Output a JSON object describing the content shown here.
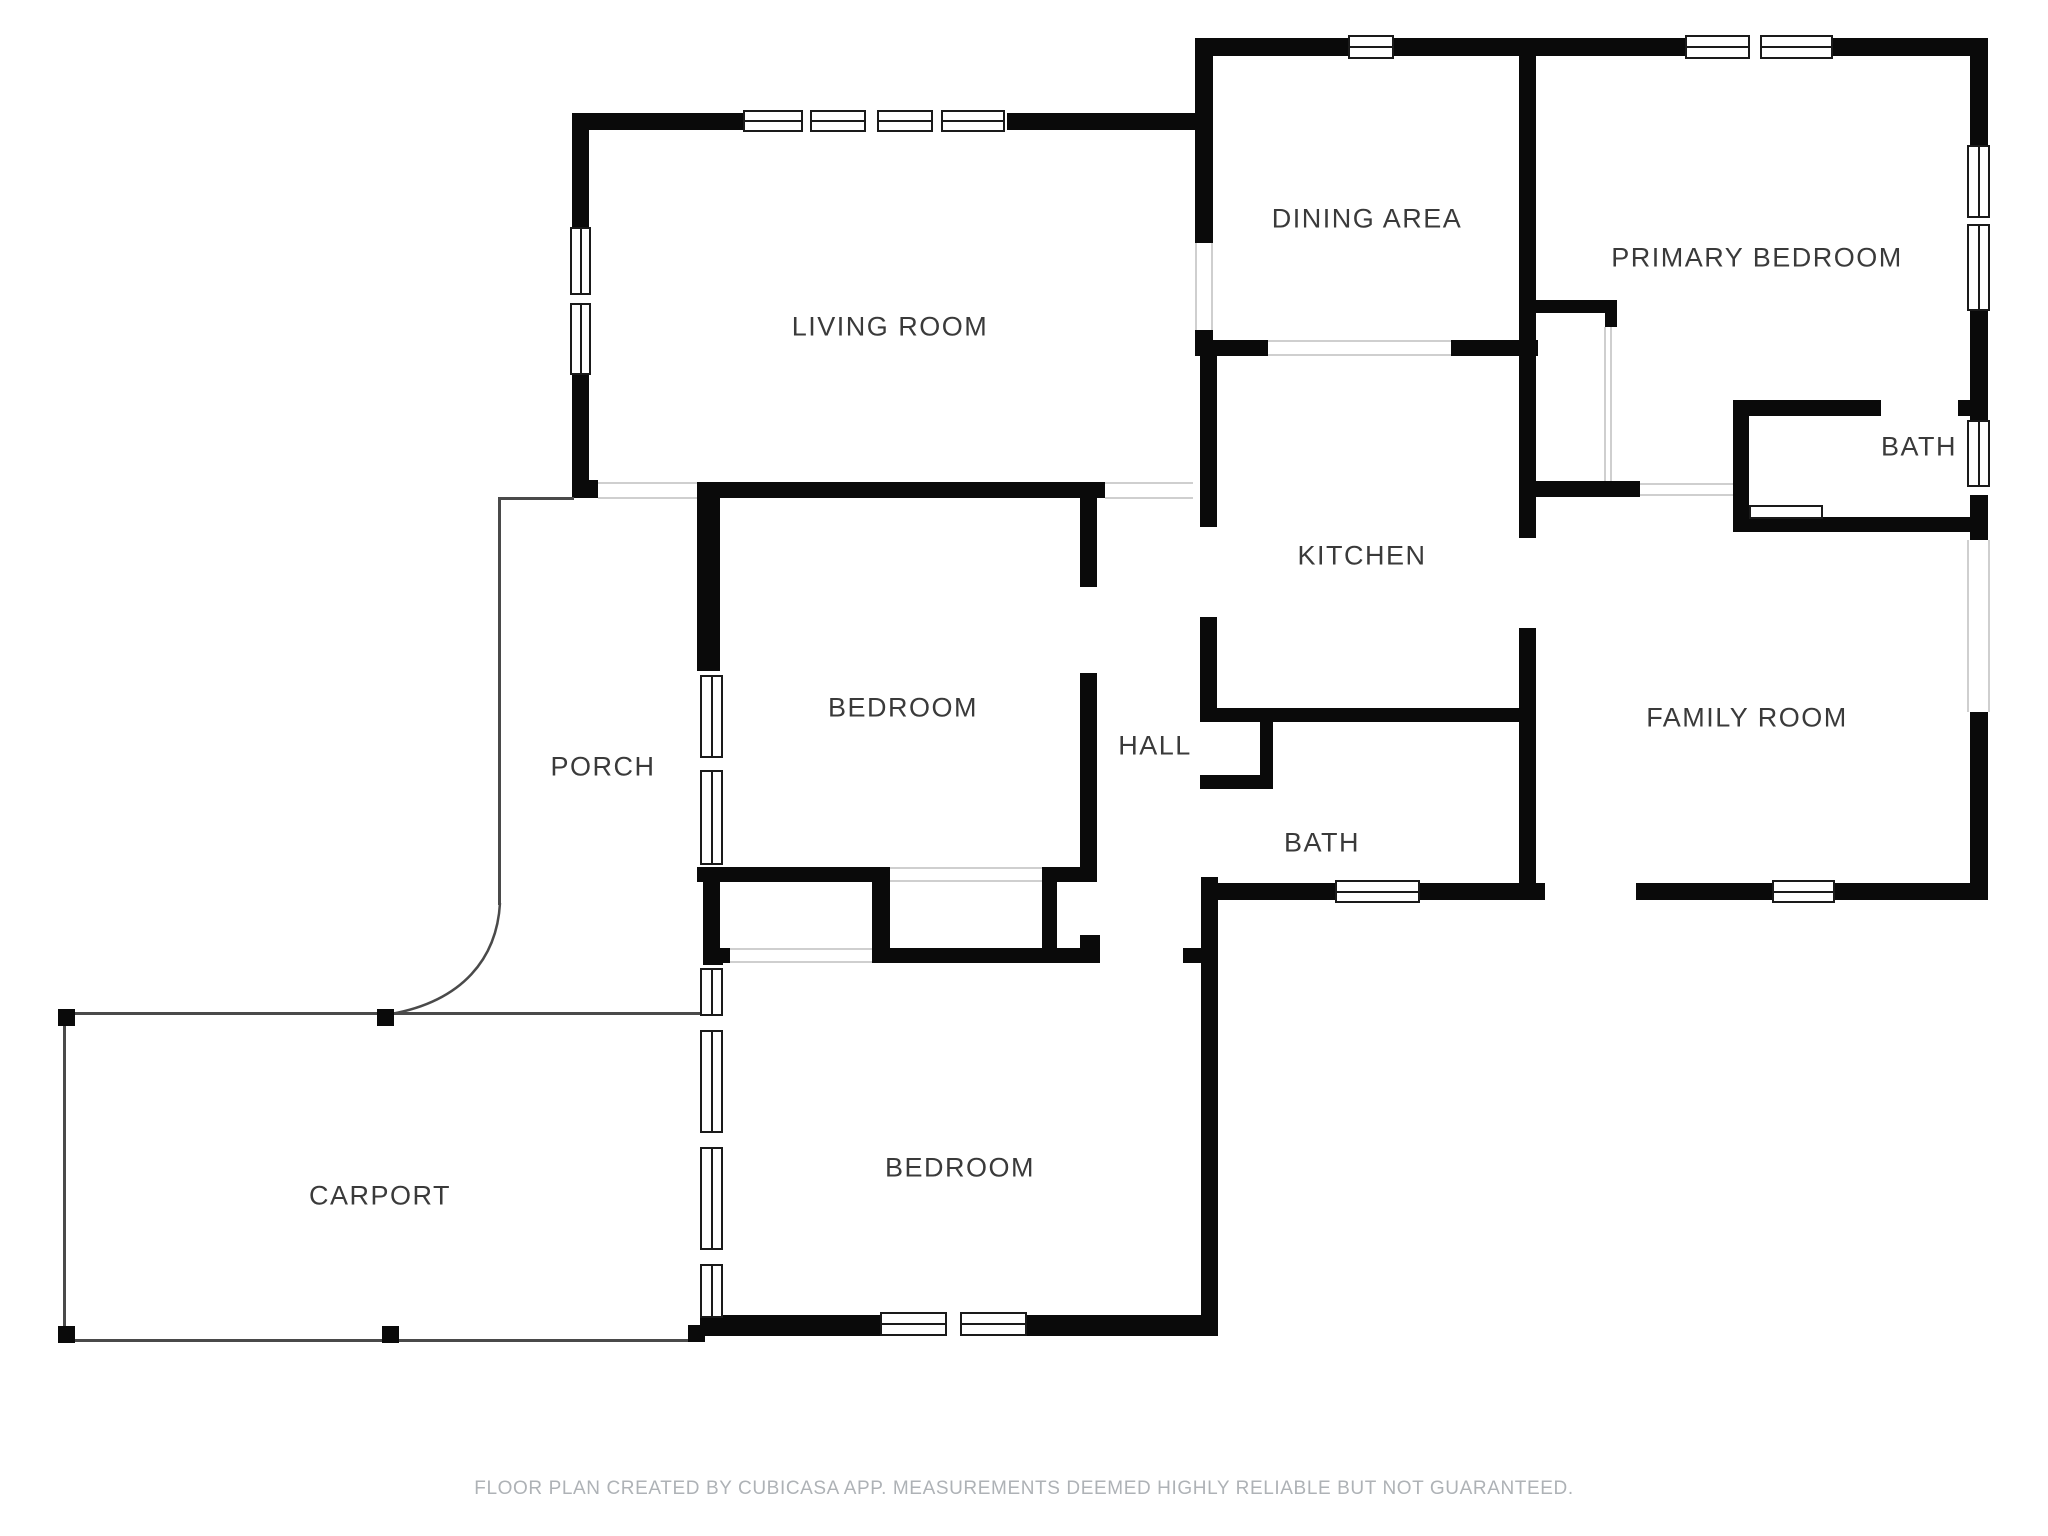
{
  "page": {
    "width": 2048,
    "height": 1536,
    "background": "#ffffff"
  },
  "footer": {
    "text": "FLOOR PLAN CREATED BY CUBICASA APP. MEASUREMENTS DEEMED HIGHLY RELIABLE BUT NOT GUARANTEED."
  },
  "colors": {
    "wall": "#0a0a0a",
    "label": "#3a3a3a",
    "outline": "#4a4a4a",
    "opening_edge": "#cfcfcf",
    "window_frame": "#1a1a1a",
    "footer_text": "#aeb2b6"
  },
  "rooms": [
    {
      "id": "living-room",
      "label": "LIVING ROOM",
      "cx": 890,
      "cy": 327
    },
    {
      "id": "dining-area",
      "label": "DINING AREA",
      "cx": 1367,
      "cy": 219
    },
    {
      "id": "primary-bedroom",
      "label": "PRIMARY BEDROOM",
      "cx": 1757,
      "cy": 258
    },
    {
      "id": "bath-upper",
      "label": "BATH",
      "cx": 1919,
      "cy": 447
    },
    {
      "id": "kitchen",
      "label": "KITCHEN",
      "cx": 1362,
      "cy": 556
    },
    {
      "id": "hall",
      "label": "HALL",
      "cx": 1155,
      "cy": 746
    },
    {
      "id": "family-room",
      "label": "FAMILY ROOM",
      "cx": 1747,
      "cy": 718
    },
    {
      "id": "bath-center",
      "label": "BATH",
      "cx": 1322,
      "cy": 843
    },
    {
      "id": "bedroom-middle",
      "label": "BEDROOM",
      "cx": 903,
      "cy": 708
    },
    {
      "id": "bedroom-bottom",
      "label": "BEDROOM",
      "cx": 960,
      "cy": 1168
    },
    {
      "id": "porch",
      "label": "PORCH",
      "cx": 603,
      "cy": 767
    },
    {
      "id": "carport",
      "label": "CARPORT",
      "cx": 380,
      "cy": 1196
    }
  ],
  "walls": [
    {
      "x": 572,
      "y": 113,
      "w": 641,
      "h": 17
    },
    {
      "x": 1195,
      "y": 38,
      "w": 343,
      "h": 18
    },
    {
      "x": 1521,
      "y": 38,
      "w": 467,
      "h": 18
    },
    {
      "x": 572,
      "y": 113,
      "w": 17,
      "h": 114
    },
    {
      "x": 572,
      "y": 375,
      "w": 17,
      "h": 105
    },
    {
      "x": 572,
      "y": 480,
      "w": 26,
      "h": 18
    },
    {
      "x": 697,
      "y": 482,
      "w": 408,
      "h": 16
    },
    {
      "x": 1195,
      "y": 38,
      "w": 18,
      "h": 205
    },
    {
      "x": 1195,
      "y": 330,
      "w": 18,
      "h": 26
    },
    {
      "x": 1195,
      "y": 340,
      "w": 73,
      "h": 16
    },
    {
      "x": 1451,
      "y": 340,
      "w": 87,
      "h": 16
    },
    {
      "x": 1519,
      "y": 38,
      "w": 17,
      "h": 500
    },
    {
      "x": 1519,
      "y": 628,
      "w": 17,
      "h": 272
    },
    {
      "x": 1970,
      "y": 38,
      "w": 18,
      "h": 107
    },
    {
      "x": 1970,
      "y": 311,
      "w": 18,
      "h": 109
    },
    {
      "x": 1970,
      "y": 492,
      "w": 18,
      "h": 48
    },
    {
      "x": 1970,
      "y": 712,
      "w": 18,
      "h": 188
    },
    {
      "x": 1536,
      "y": 300,
      "w": 81,
      "h": 13
    },
    {
      "x": 1605,
      "y": 313,
      "w": 12,
      "h": 14
    },
    {
      "x": 1519,
      "y": 481,
      "w": 121,
      "h": 16
    },
    {
      "x": 1733,
      "y": 400,
      "w": 148,
      "h": 16
    },
    {
      "x": 1958,
      "y": 400,
      "w": 12,
      "h": 16
    },
    {
      "x": 1733,
      "y": 400,
      "w": 16,
      "h": 130
    },
    {
      "x": 1733,
      "y": 517,
      "w": 237,
      "h": 15
    },
    {
      "x": 1200,
      "y": 342,
      "w": 17,
      "h": 185
    },
    {
      "x": 1200,
      "y": 617,
      "w": 17,
      "h": 105
    },
    {
      "x": 1200,
      "y": 708,
      "w": 336,
      "h": 14
    },
    {
      "x": 1260,
      "y": 722,
      "w": 13,
      "h": 67
    },
    {
      "x": 1200,
      "y": 775,
      "w": 73,
      "h": 14
    },
    {
      "x": 697,
      "y": 482,
      "w": 23,
      "h": 189
    },
    {
      "x": 1080,
      "y": 493,
      "w": 17,
      "h": 94
    },
    {
      "x": 1080,
      "y": 673,
      "w": 17,
      "h": 194
    },
    {
      "x": 697,
      "y": 867,
      "w": 193,
      "h": 15
    },
    {
      "x": 1042,
      "y": 867,
      "w": 55,
      "h": 15
    },
    {
      "x": 703,
      "y": 882,
      "w": 17,
      "h": 66
    },
    {
      "x": 872,
      "y": 882,
      "w": 18,
      "h": 66
    },
    {
      "x": 1042,
      "y": 882,
      "w": 15,
      "h": 66
    },
    {
      "x": 1080,
      "y": 935,
      "w": 20,
      "h": 17
    },
    {
      "x": 703,
      "y": 948,
      "w": 27,
      "h": 15
    },
    {
      "x": 872,
      "y": 948,
      "w": 228,
      "h": 15
    },
    {
      "x": 1183,
      "y": 948,
      "w": 35,
      "h": 15
    },
    {
      "x": 1201,
      "y": 877,
      "w": 17,
      "h": 459
    },
    {
      "x": 1202,
      "y": 883,
      "w": 133,
      "h": 17
    },
    {
      "x": 1420,
      "y": 883,
      "w": 116,
      "h": 17
    },
    {
      "x": 1519,
      "y": 883,
      "w": 26,
      "h": 17
    },
    {
      "x": 1636,
      "y": 883,
      "w": 136,
      "h": 17
    },
    {
      "x": 1835,
      "y": 883,
      "w": 153,
      "h": 17
    },
    {
      "x": 703,
      "y": 948,
      "w": 20,
      "h": 22
    },
    {
      "x": 700,
      "y": 1318,
      "w": 23,
      "h": 18
    },
    {
      "x": 703,
      "y": 1315,
      "w": 177,
      "h": 21
    },
    {
      "x": 1027,
      "y": 1315,
      "w": 191,
      "h": 21
    }
  ],
  "openings": [
    {
      "x": 598,
      "y": 482,
      "w": 99,
      "h": 17,
      "orient": "h",
      "lines": true
    },
    {
      "x": 1105,
      "y": 482,
      "w": 88,
      "h": 17,
      "orient": "h",
      "lines": true
    },
    {
      "x": 1195,
      "y": 243,
      "w": 18,
      "h": 87,
      "orient": "v",
      "lines": true
    },
    {
      "x": 1268,
      "y": 340,
      "w": 183,
      "h": 16,
      "orient": "h",
      "lines": true
    },
    {
      "x": 890,
      "y": 867,
      "w": 152,
      "h": 15,
      "orient": "h",
      "lines": true
    },
    {
      "x": 730,
      "y": 948,
      "w": 142,
      "h": 15,
      "orient": "h",
      "lines": true
    },
    {
      "x": 1967,
      "y": 540,
      "w": 23,
      "h": 172,
      "orient": "v",
      "lines": true
    },
    {
      "x": 1640,
      "y": 483,
      "w": 93,
      "h": 13,
      "orient": "h",
      "lines": true
    },
    {
      "x": 1604,
      "y": 327,
      "w": 8,
      "h": 154,
      "orient": "v",
      "lines": true
    }
  ],
  "windows": [
    {
      "x": 743,
      "y": 110,
      "w": 264,
      "h": 22,
      "orient": "h",
      "panes": [
        [
          743,
          60
        ],
        [
          810,
          56
        ],
        [
          877,
          56
        ],
        [
          941,
          64
        ]
      ]
    },
    {
      "x": 570,
      "y": 227,
      "w": 21,
      "h": 148,
      "orient": "v",
      "panes": [
        [
          227,
          68
        ],
        [
          303,
          72
        ]
      ]
    },
    {
      "x": 1348,
      "y": 35,
      "w": 46,
      "h": 24,
      "orient": "h",
      "panes": [
        [
          1348,
          46
        ]
      ]
    },
    {
      "x": 1685,
      "y": 35,
      "w": 148,
      "h": 24,
      "orient": "h",
      "panes": [
        [
          1685,
          65
        ],
        [
          1760,
          73
        ]
      ]
    },
    {
      "x": 1967,
      "y": 145,
      "w": 23,
      "h": 166,
      "orient": "v",
      "panes": [
        [
          145,
          73
        ],
        [
          224,
          87
        ]
      ]
    },
    {
      "x": 1967,
      "y": 420,
      "w": 23,
      "h": 75,
      "orient": "v",
      "panes": [
        [
          420,
          67
        ]
      ]
    },
    {
      "x": 1772,
      "y": 880,
      "w": 63,
      "h": 23,
      "orient": "h",
      "panes": [
        [
          1772,
          63
        ]
      ]
    },
    {
      "x": 1335,
      "y": 880,
      "w": 85,
      "h": 23,
      "orient": "h",
      "panes": [
        [
          1335,
          85
        ]
      ]
    },
    {
      "x": 880,
      "y": 1312,
      "w": 147,
      "h": 24,
      "orient": "h",
      "panes": [
        [
          880,
          67
        ],
        [
          960,
          67
        ]
      ]
    },
    {
      "x": 700,
      "y": 965,
      "w": 23,
      "h": 353,
      "orient": "v",
      "panes": [
        [
          968,
          48
        ],
        [
          1030,
          103
        ],
        [
          1147,
          103
        ],
        [
          1264,
          54
        ]
      ]
    },
    {
      "x": 700,
      "y": 675,
      "w": 23,
      "h": 192,
      "orient": "v",
      "panes": [
        [
          675,
          83
        ],
        [
          770,
          95
        ]
      ]
    }
  ],
  "outlines": {
    "lines": [
      {
        "x": 499,
        "y": 497,
        "w": 75,
        "h": 3
      },
      {
        "x": 498,
        "y": 497,
        "w": 3,
        "h": 408
      },
      {
        "x": 64,
        "y": 1012,
        "w": 636,
        "h": 3
      },
      {
        "x": 63,
        "y": 1012,
        "w": 3,
        "h": 330
      },
      {
        "x": 64,
        "y": 1339,
        "w": 640,
        "h": 3
      }
    ],
    "curve": {
      "path": "M 500 903 C 497 958 463 1001 391 1014"
    }
  },
  "posts": [
    {
      "x": 58,
      "y": 1009,
      "w": 17,
      "h": 17
    },
    {
      "x": 377,
      "y": 1009,
      "w": 17,
      "h": 17
    },
    {
      "x": 58,
      "y": 1326,
      "w": 17,
      "h": 17
    },
    {
      "x": 382,
      "y": 1326,
      "w": 17,
      "h": 17
    },
    {
      "x": 688,
      "y": 1325,
      "w": 17,
      "h": 17
    }
  ],
  "fixtures": [
    {
      "type": "vanity",
      "x": 1749,
      "y": 505,
      "w": 74,
      "h": 14
    }
  ]
}
